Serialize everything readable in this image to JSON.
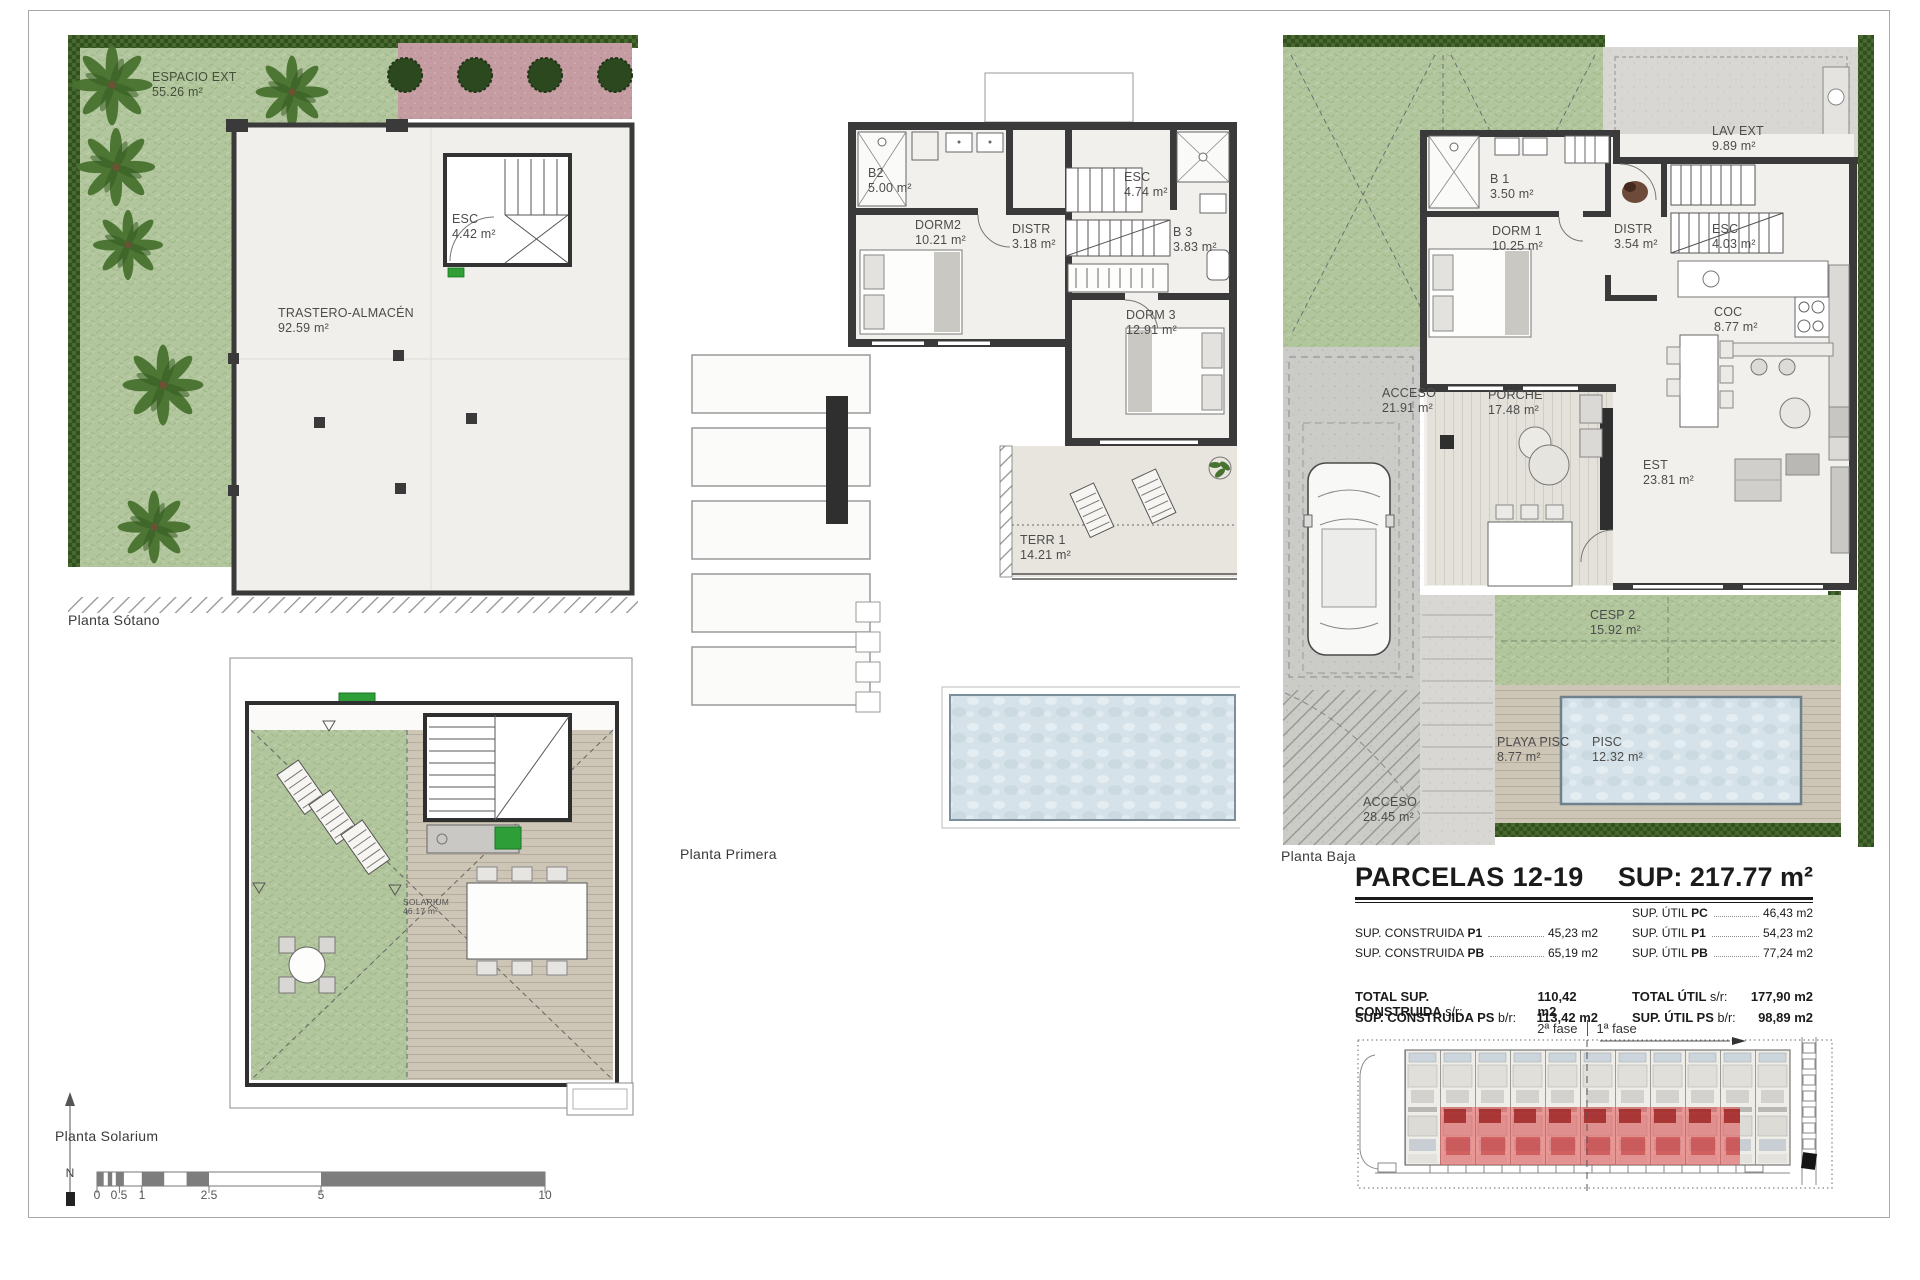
{
  "sheet": {
    "north_label": "N"
  },
  "plans": {
    "sotano": {
      "title": "Planta Sótano",
      "rooms": [
        {
          "name": "ESPACIO EXT",
          "area": "55.26 m²"
        },
        {
          "name": "ESC",
          "area": "4.42 m²"
        },
        {
          "name": "TRASTERO-ALMACÉN",
          "area": "92.59 m²"
        }
      ]
    },
    "primera": {
      "title": "Planta Primera",
      "rooms": [
        {
          "name": "B2",
          "area": "5.00 m²"
        },
        {
          "name": "DORM2",
          "area": "10.21 m²"
        },
        {
          "name": "DISTR",
          "area": "3.18 m²"
        },
        {
          "name": "ESC",
          "area": "4.74 m²"
        },
        {
          "name": "B 3",
          "area": "3.83 m²"
        },
        {
          "name": "DORM 3",
          "area": "12.91 m²"
        },
        {
          "name": "TERR 1",
          "area": "14.21 m²"
        }
      ]
    },
    "baja": {
      "title": "Planta Baja",
      "rooms": [
        {
          "name": "LAV EXT",
          "area": "9.89 m²"
        },
        {
          "name": "B 1",
          "area": "3.50 m²"
        },
        {
          "name": "DORM 1",
          "area": "10.25 m²"
        },
        {
          "name": "DISTR",
          "area": "3.54 m²"
        },
        {
          "name": "ESC",
          "area": "4.03 m²"
        },
        {
          "name": "COC",
          "area": "8.77 m²"
        },
        {
          "name": "ACCESO",
          "area": "21.91 m²"
        },
        {
          "name": "PORCHE",
          "area": "17.48 m²"
        },
        {
          "name": "EST",
          "area": "23.81 m²"
        },
        {
          "name": "CESP 2",
          "area": "15.92 m²"
        },
        {
          "name": "PLAYA PISC",
          "area": "8.77 m²"
        },
        {
          "name": "PISC",
          "area": "12.32 m²"
        },
        {
          "name": "ACCESO",
          "area": "28.45 m²"
        }
      ]
    },
    "solarium": {
      "title": "Planta Solarium",
      "rooms": [
        {
          "name": "SOLARIUM",
          "area": "46.17 m²"
        }
      ]
    }
  },
  "summary": {
    "title": "PARCELAS 12-19",
    "total_sup": "SUP: 217.77 m²",
    "left_rows": [
      {
        "label": "SUP. CONSTRUIDA",
        "key": "P1",
        "value": "45,23 m2"
      },
      {
        "label": "SUP. CONSTRUIDA",
        "key": "PB",
        "value": "65,19 m2"
      }
    ],
    "left_totals": [
      {
        "label": "TOTAL SUP. CONSTRUIDA",
        "suffix": "s/r:",
        "value": "110,42 m2"
      },
      {
        "label": "SUP. CONSTRUIDA PS",
        "suffix": "b/r:",
        "value": "113,42 m2"
      }
    ],
    "right_rows": [
      {
        "label": "SUP. ÚTIL",
        "key": "PC",
        "value": "46,43 m2"
      },
      {
        "label": "SUP. ÚTIL",
        "key": "P1",
        "value": "54,23 m2"
      },
      {
        "label": "SUP. ÚTIL",
        "key": "PB",
        "value": "77,24 m2"
      }
    ],
    "right_totals": [
      {
        "label": "TOTAL ÚTIL",
        "suffix": "s/r:",
        "value": "177,90 m2"
      },
      {
        "label": "SUP. ÚTIL PS",
        "suffix": "b/r:",
        "value": "98,89 m2"
      }
    ],
    "phases": [
      "2ª fase",
      "1ª fase"
    ]
  },
  "scalebar": {
    "ticks": [
      "0",
      "0.5",
      "1",
      "2.5",
      "5",
      "10"
    ]
  }
}
